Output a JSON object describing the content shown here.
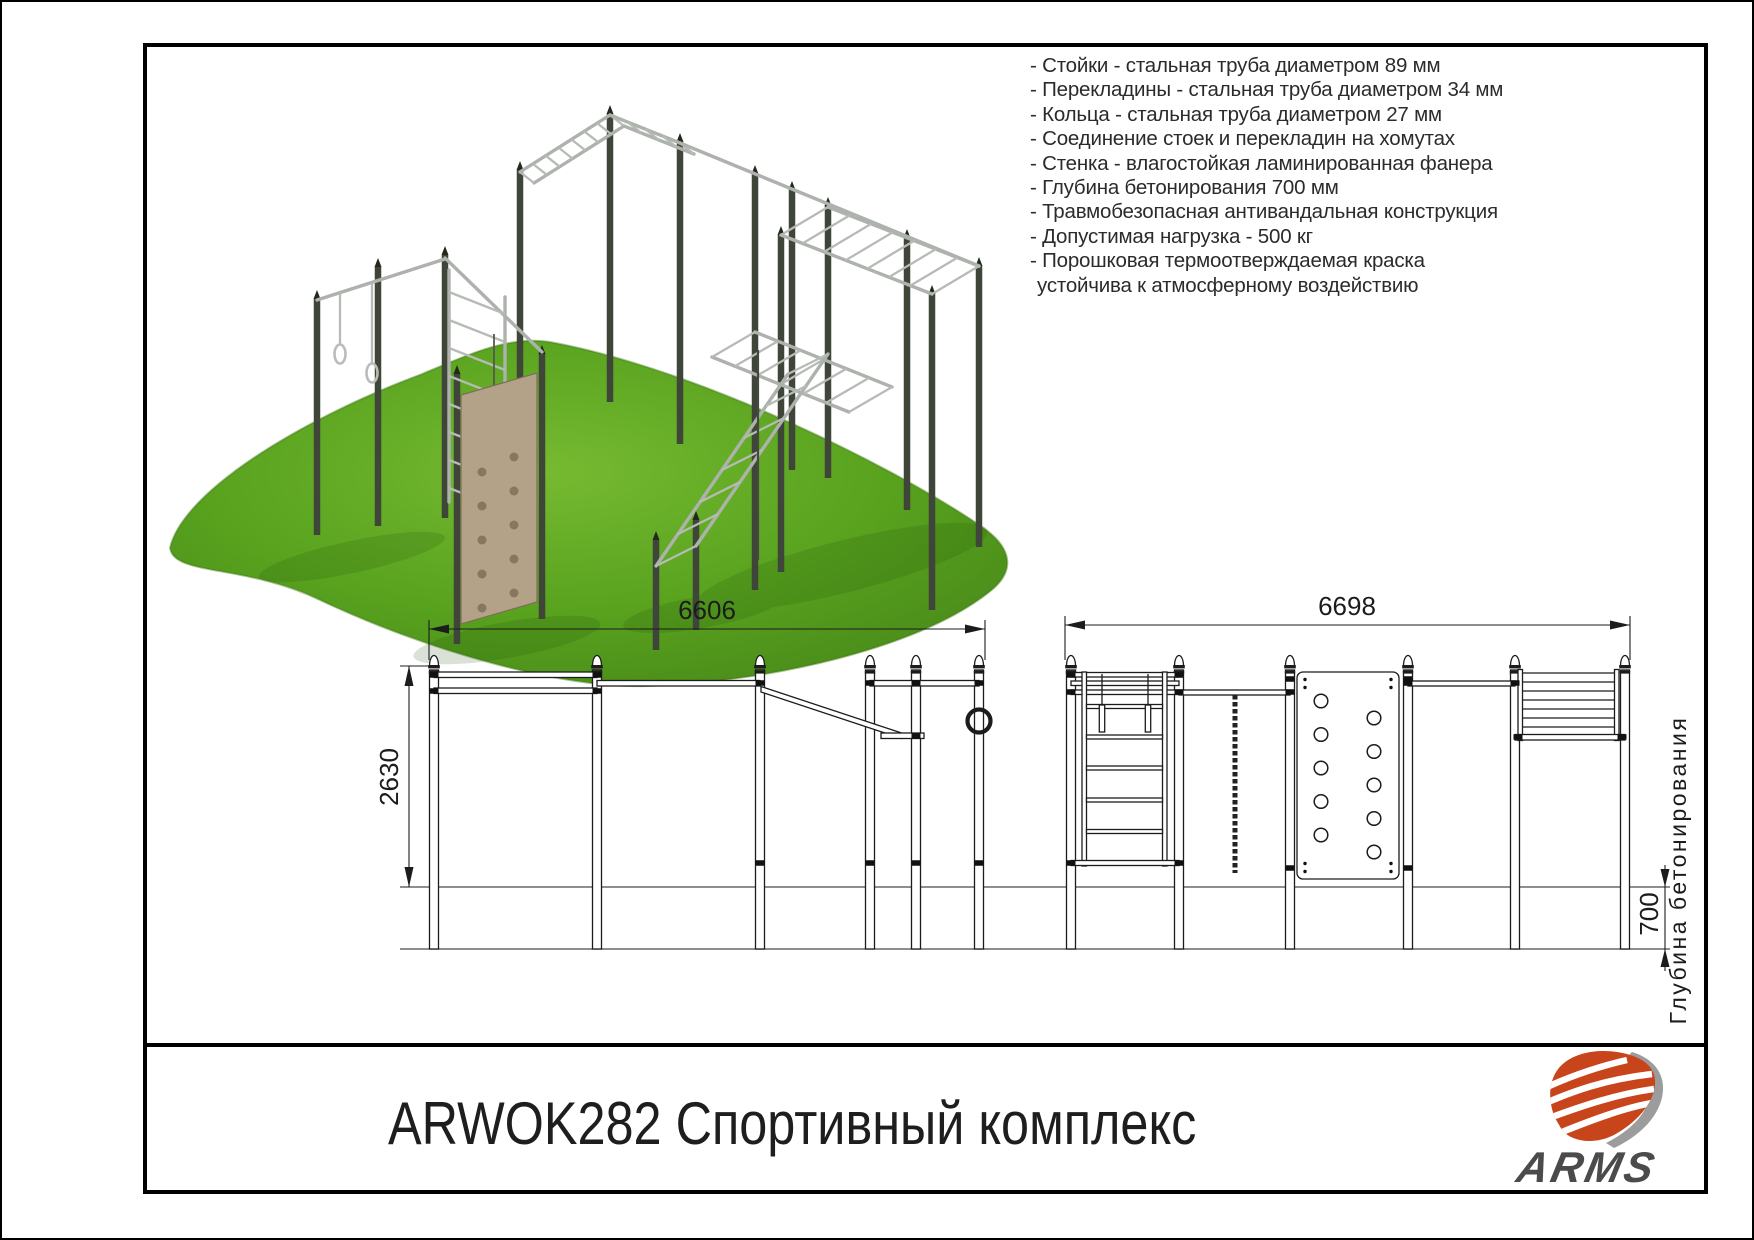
{
  "titleblock": {
    "title": "ARWOK282 Спортивный комплекс"
  },
  "logo": {
    "brand": "ARMS",
    "red": "#c8441a",
    "gray": "#9c9c9c",
    "text_color": "#4b4b4b"
  },
  "specs": {
    "lines": [
      "- Стойки - стальная труба диаметром 89 мм",
      "- Перекладины - стальная труба диаметром 34 мм",
      "- Кольца - стальная труба диаметром 27 мм",
      "- Соединение стоек и перекладин на хомутах",
      "- Стенка - влагостойкая ламинированная фанера",
      "- Глубина бетонирования 700 мм",
      "- Травмобезопасная антивандальная конструкция",
      "- Допустимая нагрузка - 500 кг",
      "- Порошковая термоотверждаемая краска",
      "устойчива к атмосферному воздействию"
    ]
  },
  "drawing": {
    "dim_width_left": "6606",
    "dim_width_right": "6698",
    "dim_height": "2630",
    "dim_depth": "700",
    "depth_label": "Глубина бетонирования"
  },
  "render": {
    "grass_green": "#5aa41f",
    "post_color": "#3f4539",
    "bar_color": "#adb2ad",
    "panel_tan": "#b3a288"
  }
}
